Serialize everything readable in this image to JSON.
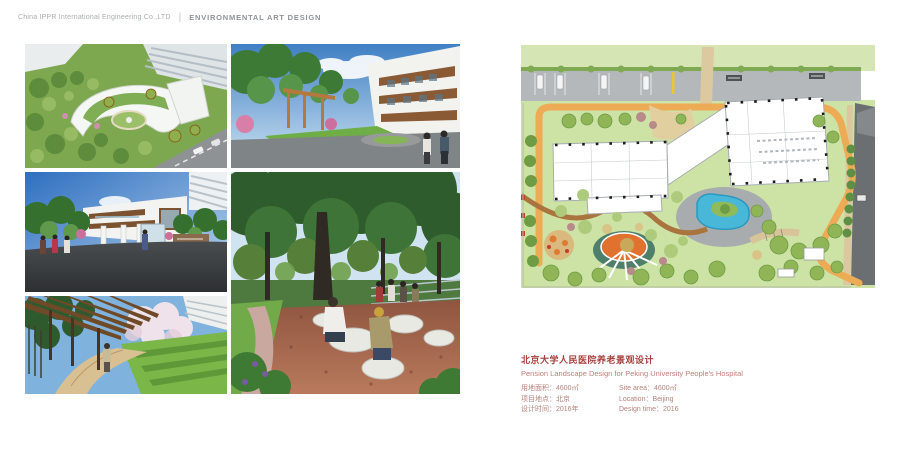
{
  "header": {
    "company": "China IPPR International Engineering Co.,LTD",
    "divider": "|",
    "department": "ENVIRONMENTAL ART DESIGN"
  },
  "project": {
    "title_cn": "北京大学人民医院养老景观设计",
    "title_en": "Pension Landscape Design for Peking University People's Hospital",
    "details": [
      {
        "cn": "用地面积：4600㎡",
        "en": "Site area：4600㎡"
      },
      {
        "cn": "项目地点：北京",
        "en": "Location：Beijing"
      },
      {
        "cn": "设计时间：2016年",
        "en": "Design time：2016"
      }
    ]
  },
  "gallery": {
    "images": [
      {
        "name": "aerial-view-rendering"
      },
      {
        "name": "courtyard-entry-rendering"
      },
      {
        "name": "main-entrance-rendering"
      },
      {
        "name": "pergola-walkway-rendering"
      },
      {
        "name": "tree-plaza-seating-rendering"
      }
    ]
  },
  "site_plan": {
    "name": "master-plan-drawing",
    "colors": {
      "lawn": "#cde3a6",
      "tree_dark": "#6d9c44",
      "tree_mid": "#8fb556",
      "tree_light": "#aecb7c",
      "ring_road": "#edab55",
      "parking": "#b4b8ba",
      "dark_road": "#6b6f71",
      "pond": "#49b8d8",
      "plaza_orange": "#e0712f",
      "path_brown": "#a9743e",
      "building": "#ffffff"
    }
  },
  "colors": {
    "accent_red": "#a8403d",
    "detail_text": "#b5827e",
    "header_gray": "#a9adb0"
  }
}
